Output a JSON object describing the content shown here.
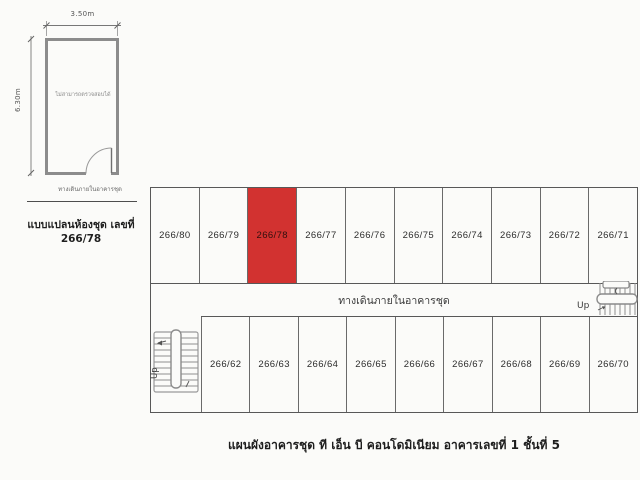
{
  "page": {
    "background": "#fbfbf9",
    "line_color": "#585858",
    "highlight_color": "#d23230"
  },
  "unit_plan": {
    "width_label": "3.50m",
    "height_label": "6.30m",
    "room_note": "ไม่สามารถตรวจสอบได้",
    "walkway_label": "ทางเดินภายในอาคารชุด",
    "caption": "แบบแปลนห้องชุด เลขที่ 266/78"
  },
  "floor_plan": {
    "top_row_units": [
      "266/80",
      "266/79",
      "266/78",
      "266/77",
      "266/76",
      "266/75",
      "266/74",
      "266/73",
      "266/72",
      "266/71"
    ],
    "bottom_row_units": [
      "266/62",
      "266/63",
      "266/64",
      "266/65",
      "266/66",
      "266/67",
      "266/68",
      "266/69",
      "266/70"
    ],
    "highlighted_unit": "266/78",
    "corridor_label": "ทางเดินภายในอาคารชุด",
    "stairs_left_label": "Up",
    "stairs_right_label": "Up"
  },
  "caption": "แผนผังอาคารชุด ที เอ็น บี คอนโดมิเนียม อาคารเลขที่ 1 ชั้นที่ 5"
}
